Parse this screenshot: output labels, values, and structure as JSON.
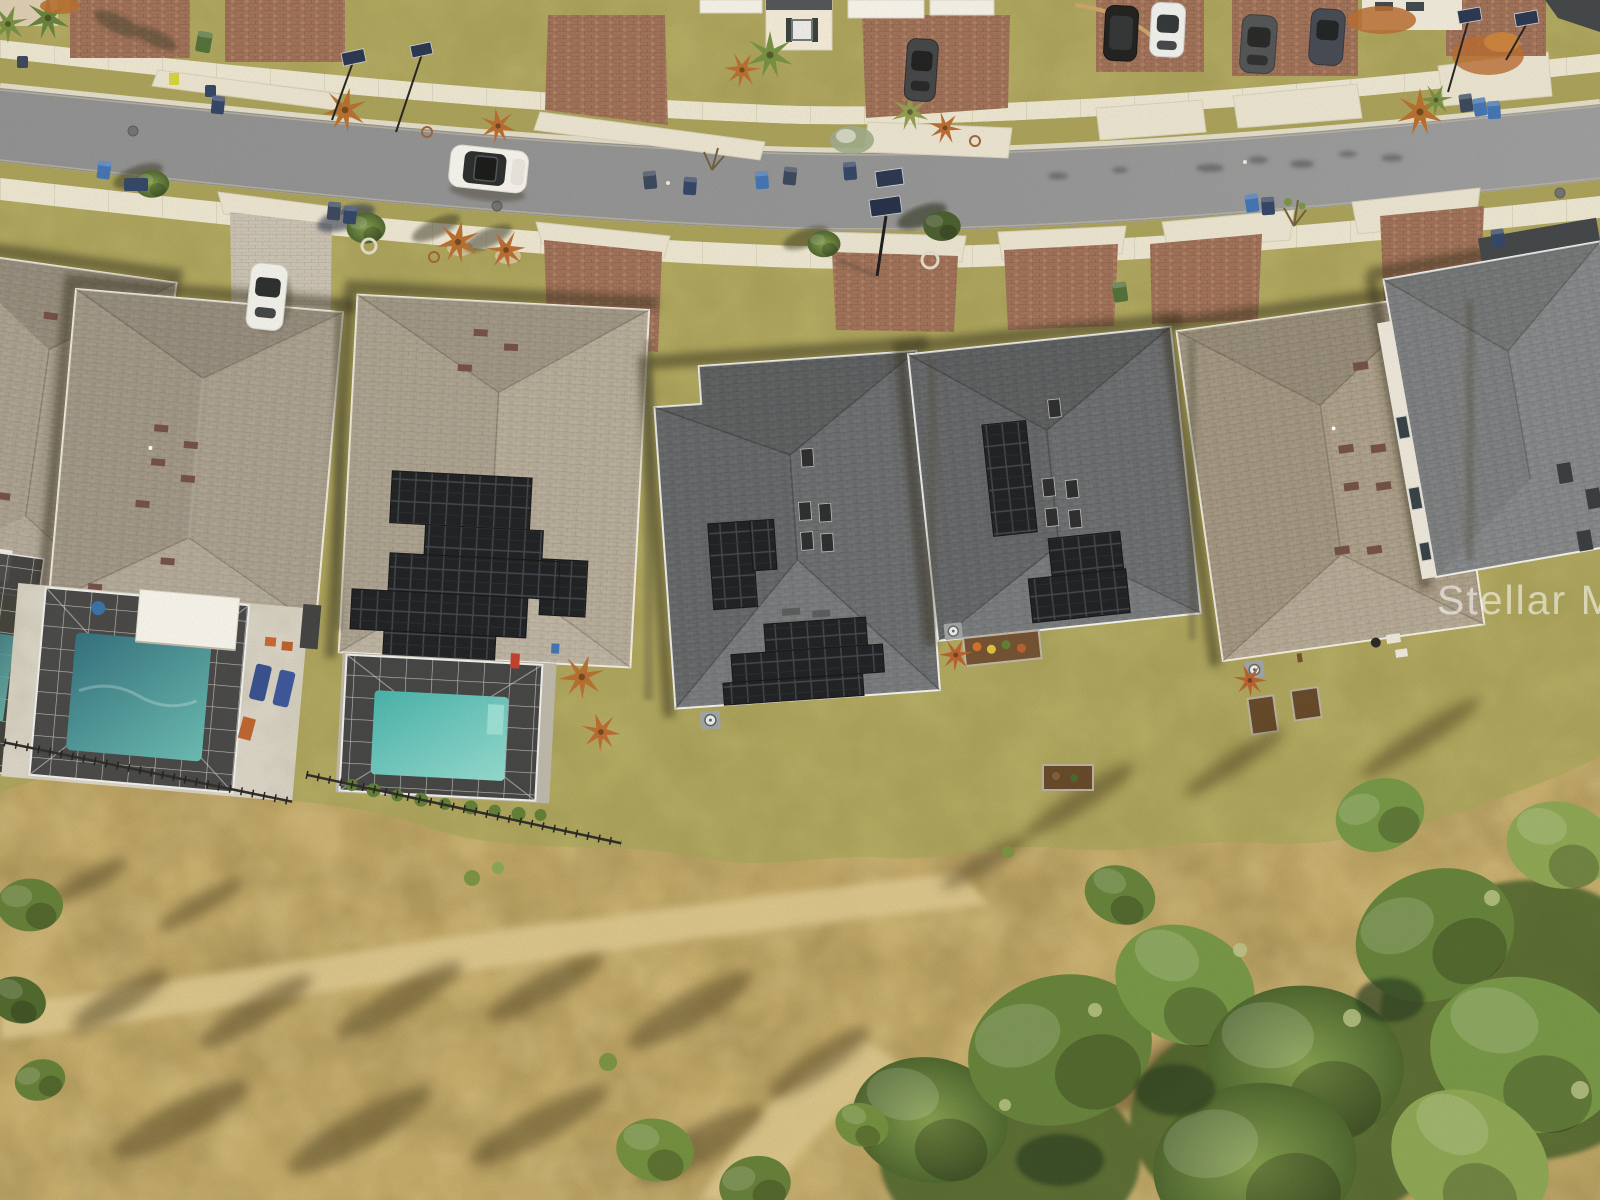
{
  "meta": {
    "kind": "aerial-drone-photo",
    "subject": "top-down view of a row of single-family homes on a curved suburban street bordering dry undeveloped scrub land with trees",
    "lighting": "low sun from southeast, long shadows cast to the upper-left"
  },
  "watermark": {
    "text": "Stellar MLS",
    "color": "#ffffff",
    "opacity": 0.55
  },
  "palette": {
    "asphalt": "#8e9095",
    "sidewalk": "#e9e4d3",
    "curb_gutter": "#dfdbca",
    "lawn": "#a9a25c",
    "scrub": "#bfa768",
    "dirt_path": "#d9c58e",
    "paver_red": "#9a6c58",
    "paver_gray": "#c6bfb4",
    "roof_taupe": "#a59c90",
    "roof_light_tan": "#b1a89a",
    "roof_dark_gray": "#64686f",
    "roof_tan_brown": "#a69b8b",
    "roof_gray": "#7e8288",
    "solar_panel": "#161920",
    "pool_water": "#49b6b2",
    "pool_shaded": "#2a6b7d",
    "screen_enclosure": "#2b2e33",
    "canopy_white": "#f4f3ee",
    "tree_green": "#5f7e38",
    "palm_rust": "#b36a2c",
    "shadow": "#2c2817",
    "trash_bin_blue": "#3a6fb5",
    "trash_bin_green": "#4a6b35",
    "trash_bin_dark": "#2b3f66",
    "street_sign_navy": "#22304f",
    "car_white": "#f1f2ef",
    "car_black": "#17191d",
    "car_gray": "#4a4e54",
    "car_blue": "#3d4452"
  },
  "inventory": {
    "houses_visible": 7,
    "houses_with_solar_panels": 3,
    "screened_pool_enclosures": 3,
    "vehicles_driving_on_street": 1,
    "vehicles_parked": 6,
    "street_sign_posts": 5,
    "curbside_trash_bins": 14,
    "features": [
      "curved residential street",
      "concrete sidewalks on both sides",
      "driveway aprons and brick-paver driveways",
      "white pool cabana canopy",
      "teal screened swimming pools",
      "black metal rear yard fences",
      "raised garden beds",
      "air-conditioner pads",
      "pale dirt walking path",
      "dense oak canopy at lower right",
      "long tree shadows on dry grass"
    ]
  }
}
